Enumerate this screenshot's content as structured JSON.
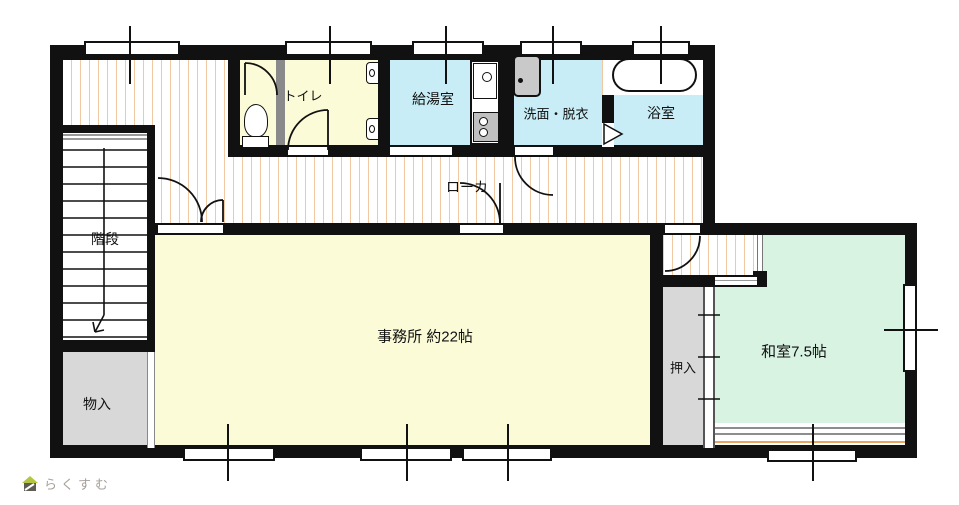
{
  "logo": {
    "text": "らくすむ"
  },
  "rooms": {
    "stairs": {
      "label": "階段"
    },
    "storage": {
      "label": "物入"
    },
    "toilet": {
      "label": "トイレ"
    },
    "kitchenette": {
      "label": "給湯室"
    },
    "washroom": {
      "label": "洗面・脱衣"
    },
    "bathroom": {
      "label": "浴室"
    },
    "corridor": {
      "label": "ローカ"
    },
    "office": {
      "label": "事務所 約22帖"
    },
    "closet": {
      "label": "押入"
    },
    "japanese_room": {
      "label": "和室7.5帖"
    }
  },
  "colors": {
    "wall": "#111111",
    "room_yellow": "#fbfbd8",
    "room_cyan": "#c8edf6",
    "room_green": "#d9f3e2",
    "room_gray": "#d8d8d8",
    "partition_gray": "#8a8a8a",
    "stripe": "#f0c9a2",
    "tatami_line": "#e8a662",
    "logo_text": "#a5a09a",
    "logo_roof": "#b3c543",
    "logo_body": "#5f5b55"
  }
}
